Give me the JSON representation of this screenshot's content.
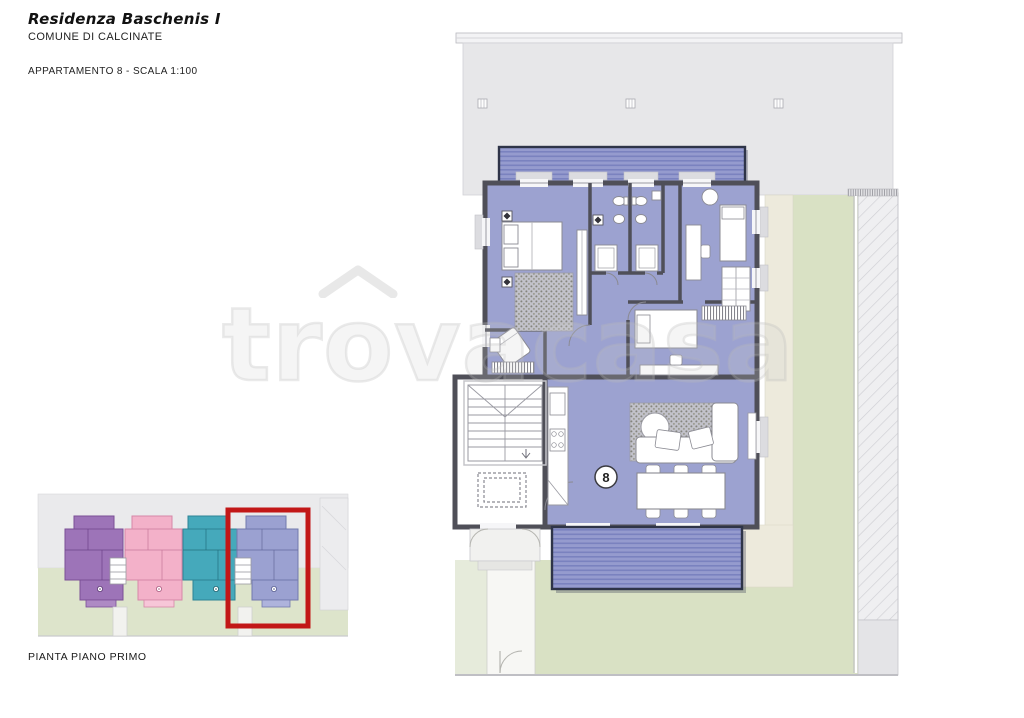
{
  "header": {
    "title": "Residenza Baschenis I",
    "subtitle": "COMUNE DI CALCINATE",
    "plan_label": "APPARTAMENTO 8 - SCALA 1:100"
  },
  "main_plan": {
    "apartment_number": "8"
  },
  "overview": {
    "label": "PIANTA PIANO PRIMO",
    "highlighted_unit": "8"
  },
  "watermark": {
    "part1": "tr",
    "part2": "o",
    "part3": "vacasa"
  },
  "colors": {
    "apartment_fill": "#9ca2d0",
    "balcony_fill": "#959bce",
    "balcony_stripe": "#7a82bf",
    "wall": "#4f4f58",
    "terrace_gray": "#e7e7e9",
    "garden_green": "#d9e1c4",
    "patio_beige": "#edeadc",
    "unit_purple": "#9d74b8",
    "unit_pink": "#f3b1c9",
    "unit_teal": "#45a9bb",
    "unit_lavender": "#9ba1d1",
    "highlight_red": "#c21717"
  }
}
